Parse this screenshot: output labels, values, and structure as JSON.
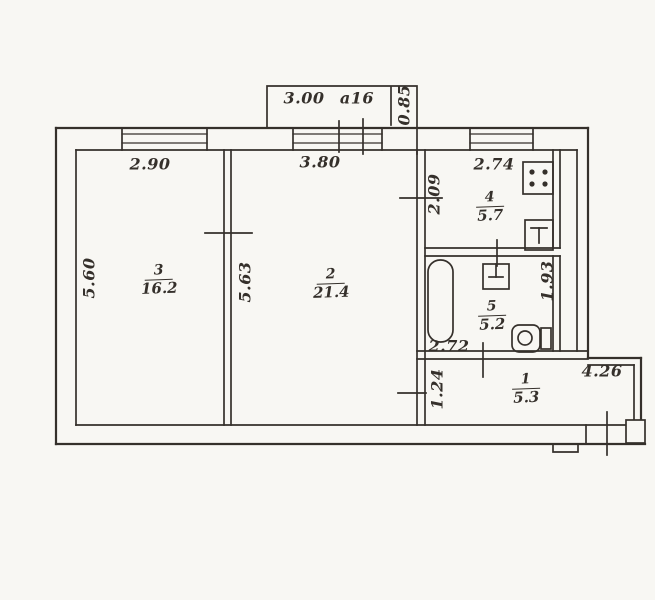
{
  "drawing": {
    "type": "apartment floor plan",
    "balcony": {
      "width": "3.00",
      "code": "a16",
      "depth": "0.85"
    },
    "rooms": {
      "room3": {
        "number": "3",
        "area": "16.2"
      },
      "room2": {
        "number": "2",
        "area": "21.4"
      },
      "kitchen": {
        "number": "4",
        "area": "5.7"
      },
      "bathroom": {
        "number": "5",
        "area": "5.2"
      },
      "hallway": {
        "number": "1",
        "area": "5.3"
      }
    },
    "dimensions": {
      "room3_width": "2.90",
      "room2_width": "3.80",
      "kitchen_width": "2.74",
      "room3_depth": "5.60",
      "room2_depth": "5.63",
      "kitchen_depth": "2.09",
      "duct_depth": "1.93",
      "bathroom_width": "2.72",
      "hallway_depth": "1.24",
      "hallway_width": "4.26"
    },
    "fixtures": [
      "stove-icon",
      "kitchen-sink-icon",
      "bathtub-icon",
      "wash-basin-icon",
      "toilet-icon"
    ],
    "colors": {
      "ink": "#35302b",
      "paper": "#f8f7f3"
    }
  }
}
